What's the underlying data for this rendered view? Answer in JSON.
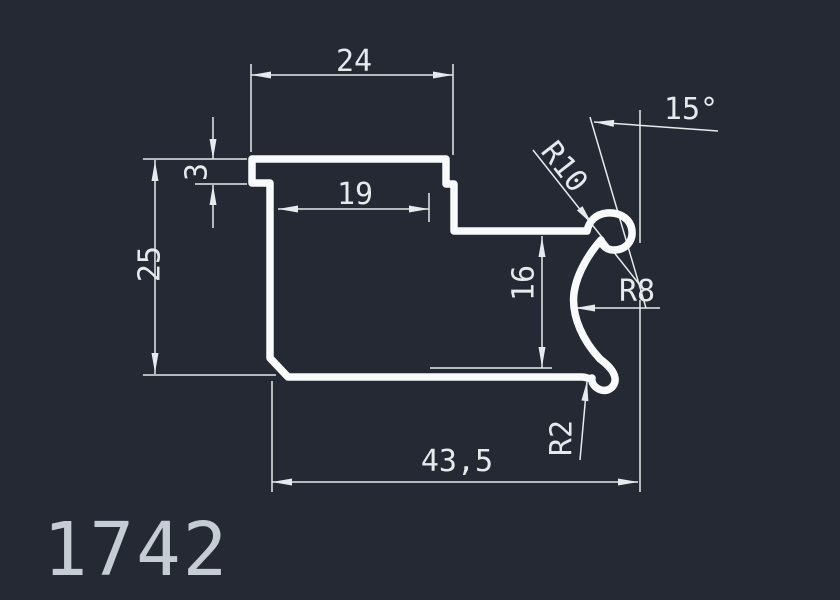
{
  "canvas": {
    "background_color": "#242933",
    "profile_line_color": "#f8fafb",
    "dimension_color": "#e6eaed",
    "title_color": "#c6ccd3"
  },
  "part": {
    "number": "1742"
  },
  "dimensions": {
    "flange_width": "24",
    "flange_step_thickness": "3",
    "inner_width": "19",
    "left_height": "25",
    "right_height": "16",
    "total_width": "43,5",
    "angle": "15°",
    "radius_large": "R10",
    "radius_mid": "R8",
    "radius_small": "R2"
  }
}
